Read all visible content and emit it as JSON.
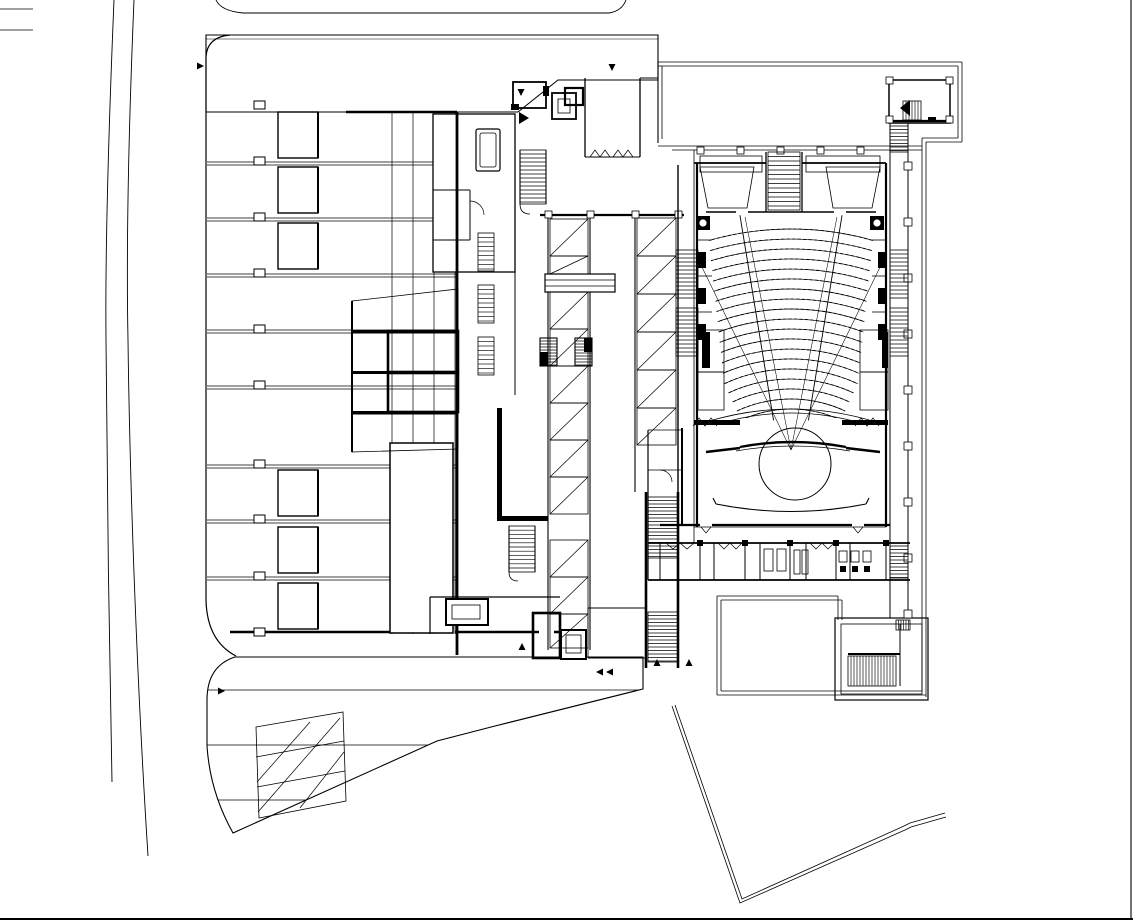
{
  "canvas": {
    "width": 1136,
    "height": 923,
    "paper_color": "#ffffff",
    "ink_color": "#000000"
  },
  "plan": {
    "regions": {
      "glass_roof_grid": "glass-roof-grid",
      "entry_canopy": "entry-canopy-hatch",
      "grand_stair": "grand-stair-hatch",
      "auditorium": "auditorium-seating",
      "stage": "stage-revolve",
      "south_plaza": "south-plaza-paving",
      "north_terrace": "north-terrace",
      "site_path": "site-path"
    },
    "seating": {
      "rows": 19,
      "radius_start": 118,
      "radius_step": 10,
      "center_x": 791,
      "center_y": 527,
      "half_angle_deg": 25,
      "aisle_angle_deg": 9.3,
      "aisle_r1": 108,
      "aisle_r2": 316,
      "clip": [
        [
          706,
          214
        ],
        [
          876,
          214
        ],
        [
          854,
          418
        ],
        [
          728,
          418
        ]
      ],
      "seat_dash": [
        3.6,
        1.9
      ],
      "seat_band_width": 3.6
    },
    "glass_roof": {
      "x": 206,
      "y": 112,
      "w": 251,
      "h": 522,
      "beam_rows": [
        162,
        218,
        274,
        330,
        386,
        465,
        520,
        577
      ],
      "beam_x1": 207,
      "beam_x2": 457,
      "beam_gap": 3,
      "skylight": {
        "x": 278,
        "w": 40,
        "h": 46,
        "rows": [
          112,
          167,
          223,
          470,
          527,
          583
        ]
      },
      "column_marker": {
        "x": 254,
        "w": 11,
        "h": 8,
        "rows": [
          101,
          157,
          213,
          269,
          325,
          381,
          460,
          515,
          572,
          628
        ]
      },
      "sparse_lines_x": [
        392,
        413,
        434,
        455
      ]
    },
    "escalators_west": {
      "x": 550,
      "w": 38,
      "cell_h": 37,
      "segments": [
        [
          219,
          274
        ],
        [
          292,
          514
        ],
        [
          540,
          648
        ]
      ]
    },
    "escalators_east": {
      "x": 637,
      "w": 39,
      "cell_h": 38,
      "segments": [
        [
          218,
          445
        ]
      ]
    },
    "tread_stacks": [
      {
        "x": 676,
        "y": 250,
        "w": 22,
        "h": 48,
        "sp": 4,
        "o": "h"
      },
      {
        "x": 676,
        "y": 308,
        "w": 22,
        "h": 48,
        "sp": 4,
        "o": "h"
      },
      {
        "x": 890,
        "y": 250,
        "w": 18,
        "h": 48,
        "sp": 4,
        "o": "h"
      },
      {
        "x": 890,
        "y": 308,
        "w": 18,
        "h": 48,
        "sp": 4,
        "o": "h"
      },
      {
        "x": 768,
        "y": 152,
        "w": 32,
        "h": 58,
        "sp": 4.5,
        "o": "h"
      },
      {
        "x": 890,
        "y": 126,
        "w": 18,
        "h": 26,
        "sp": 3.5,
        "o": "h"
      },
      {
        "x": 903,
        "y": 101,
        "w": 18,
        "h": 19,
        "sp": 3,
        "o": "v"
      },
      {
        "x": 520,
        "y": 150,
        "w": 26,
        "h": 54,
        "sp": 4,
        "o": "h"
      },
      {
        "x": 509,
        "y": 526,
        "w": 26,
        "h": 46,
        "sp": 4.2,
        "o": "h"
      },
      {
        "x": 848,
        "y": 656,
        "w": 48,
        "h": 30,
        "sp": 3,
        "o": "v"
      },
      {
        "x": 890,
        "y": 546,
        "w": 18,
        "h": 32,
        "sp": 3.5,
        "o": "h"
      },
      {
        "x": 478,
        "y": 233,
        "w": 16,
        "h": 38,
        "sp": 4.5,
        "o": "h"
      },
      {
        "x": 478,
        "y": 285,
        "w": 16,
        "h": 38,
        "sp": 4.5,
        "o": "h"
      },
      {
        "x": 478,
        "y": 337,
        "w": 16,
        "h": 38,
        "sp": 4.5,
        "o": "h"
      },
      {
        "x": 540,
        "y": 338,
        "w": 17,
        "h": 28,
        "sp": 3,
        "o": "h"
      },
      {
        "x": 575,
        "y": 338,
        "w": 17,
        "h": 28,
        "sp": 3,
        "o": "h"
      },
      {
        "x": 648,
        "y": 497,
        "w": 30,
        "h": 61,
        "sp": 3.5,
        "o": "h"
      },
      {
        "x": 648,
        "y": 612,
        "w": 30,
        "h": 50,
        "sp": 3.5,
        "o": "h"
      },
      {
        "x": 896,
        "y": 620,
        "w": 14,
        "h": 10,
        "sp": 2.5,
        "o": "v"
      }
    ],
    "plaza": {
      "h_lines": [
        690,
        745,
        800
      ],
      "x1": 207,
      "x2": 643
    },
    "corridor_columns": {
      "x": 904,
      "w": 8,
      "h": 8,
      "rows": [
        162,
        218,
        274,
        330,
        386,
        442,
        498,
        554,
        610
      ]
    },
    "portico_columns_x": [
      700,
      740,
      780,
      820,
      860
    ],
    "lobby_columns_x": [
      548,
      590,
      635,
      678
    ],
    "stage_geometry": {
      "circle_cx": 795,
      "circle_cy": 464,
      "circle_r": 36
    },
    "markers": [
      {
        "x": 197,
        "y": 66,
        "dir": "right"
      },
      {
        "x": 218,
        "y": 691,
        "dir": "right"
      },
      {
        "x": 521,
        "y": 89,
        "dir": "down"
      },
      {
        "x": 612,
        "y": 64,
        "dir": "down"
      },
      {
        "x": 522,
        "y": 650,
        "dir": "up"
      },
      {
        "x": 603,
        "y": 672,
        "dir": "left"
      },
      {
        "x": 613,
        "y": 672,
        "dir": "left"
      },
      {
        "x": 657,
        "y": 666,
        "dir": "up"
      },
      {
        "x": 689,
        "y": 666,
        "dir": "up"
      }
    ],
    "marker_size": 7
  }
}
